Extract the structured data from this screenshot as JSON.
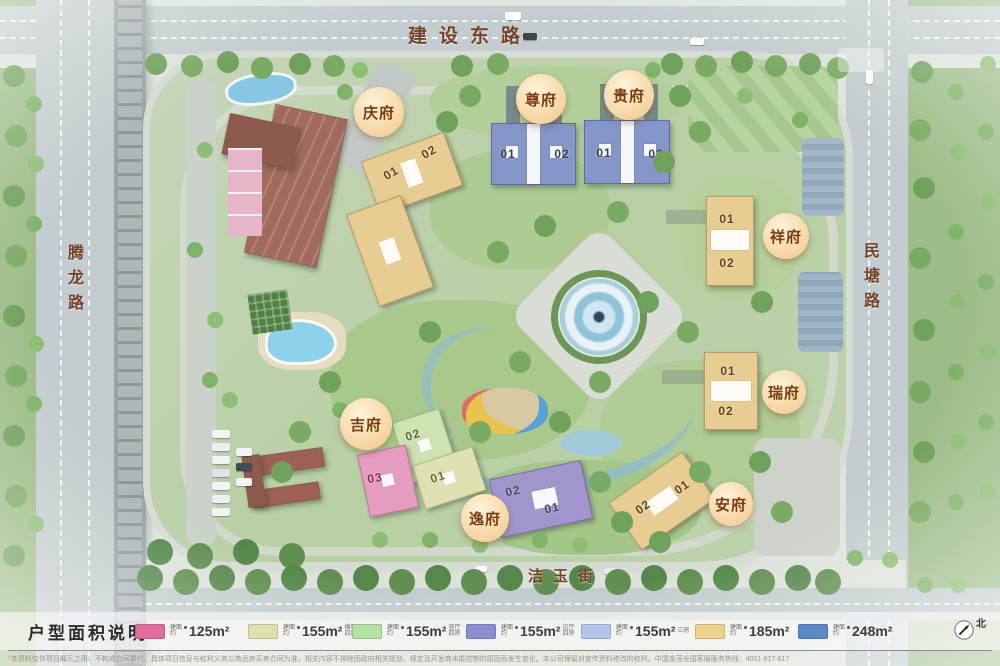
{
  "roads": {
    "top": "建设东路",
    "left": "腾龙路",
    "right": "民塘路",
    "bottom": "洁玉街"
  },
  "buildings": [
    {
      "name": "庆府",
      "units": [
        "01",
        "02"
      ]
    },
    {
      "name": "尊府",
      "units": [
        "01",
        "02"
      ]
    },
    {
      "name": "贵府",
      "units": [
        "01",
        "02"
      ]
    },
    {
      "name": "祥府",
      "units": [
        "01",
        "02"
      ]
    },
    {
      "name": "瑞府",
      "units": [
        "01",
        "02"
      ]
    },
    {
      "name": "安府",
      "units": [
        "01",
        "02"
      ]
    },
    {
      "name": "吉府",
      "units": [
        "02",
        "01",
        "03"
      ]
    },
    {
      "name": "逸府",
      "units": [
        "02",
        "01"
      ]
    }
  ],
  "legend": {
    "title": "户型面积说明",
    "prefix": "建面约",
    "items": [
      {
        "area": "125m²",
        "suffix": "",
        "color": "#df6d9e"
      },
      {
        "area": "155m²",
        "suffix": "横厅四房",
        "color": "#dfe0ad"
      },
      {
        "area": "155m²",
        "suffix": "竖厅四房",
        "color": "#b7e0a6"
      },
      {
        "area": "155m²",
        "suffix": "边厅四房",
        "color": "#8c8cd0"
      },
      {
        "area": "155m²",
        "suffix": "三房",
        "color": "#b4c4ea"
      },
      {
        "area": "185m²",
        "suffix": "",
        "color": "#ebd28d"
      },
      {
        "area": "248m²",
        "suffix": "",
        "color": "#5c88c6"
      }
    ]
  },
  "north": {
    "label": "北"
  },
  "disclaimer": "*本资料仅作项目展示之用，不构成合同要约。具体项目信息与权利义务以商品房买卖合同为准，相关内容不排除因政府相关规划、规定及开发商未能控制的原因而发生变化。本公司保留对宣传资料修改的权利。中国金茂全国客服服务热线：4001-817-817"
}
